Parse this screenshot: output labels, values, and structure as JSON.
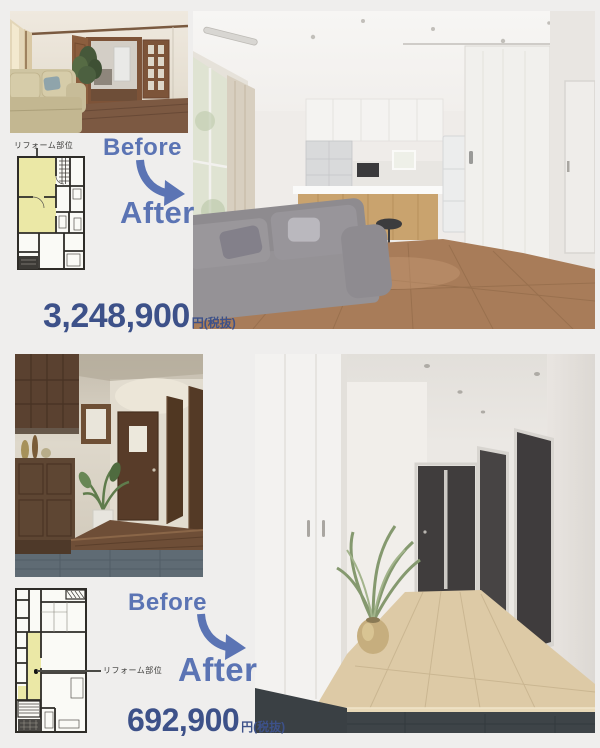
{
  "colors": {
    "label_blue": "#5b74b4",
    "price_navy": "#3d5189",
    "plan_yellow": "#ebe8a6"
  },
  "sections": [
    {
      "name": "living-dining-kitchen-case",
      "plan_label": "リフォーム部位",
      "before_label": "Before",
      "after_label": "After",
      "price": "3,248,900",
      "price_suffix": "円(税抜)"
    },
    {
      "name": "entrance-hallway-case",
      "plan_label": "リフォーム部位",
      "before_label": "Before",
      "after_label": "After",
      "price": "692,900",
      "price_suffix": "円(税抜)"
    }
  ]
}
